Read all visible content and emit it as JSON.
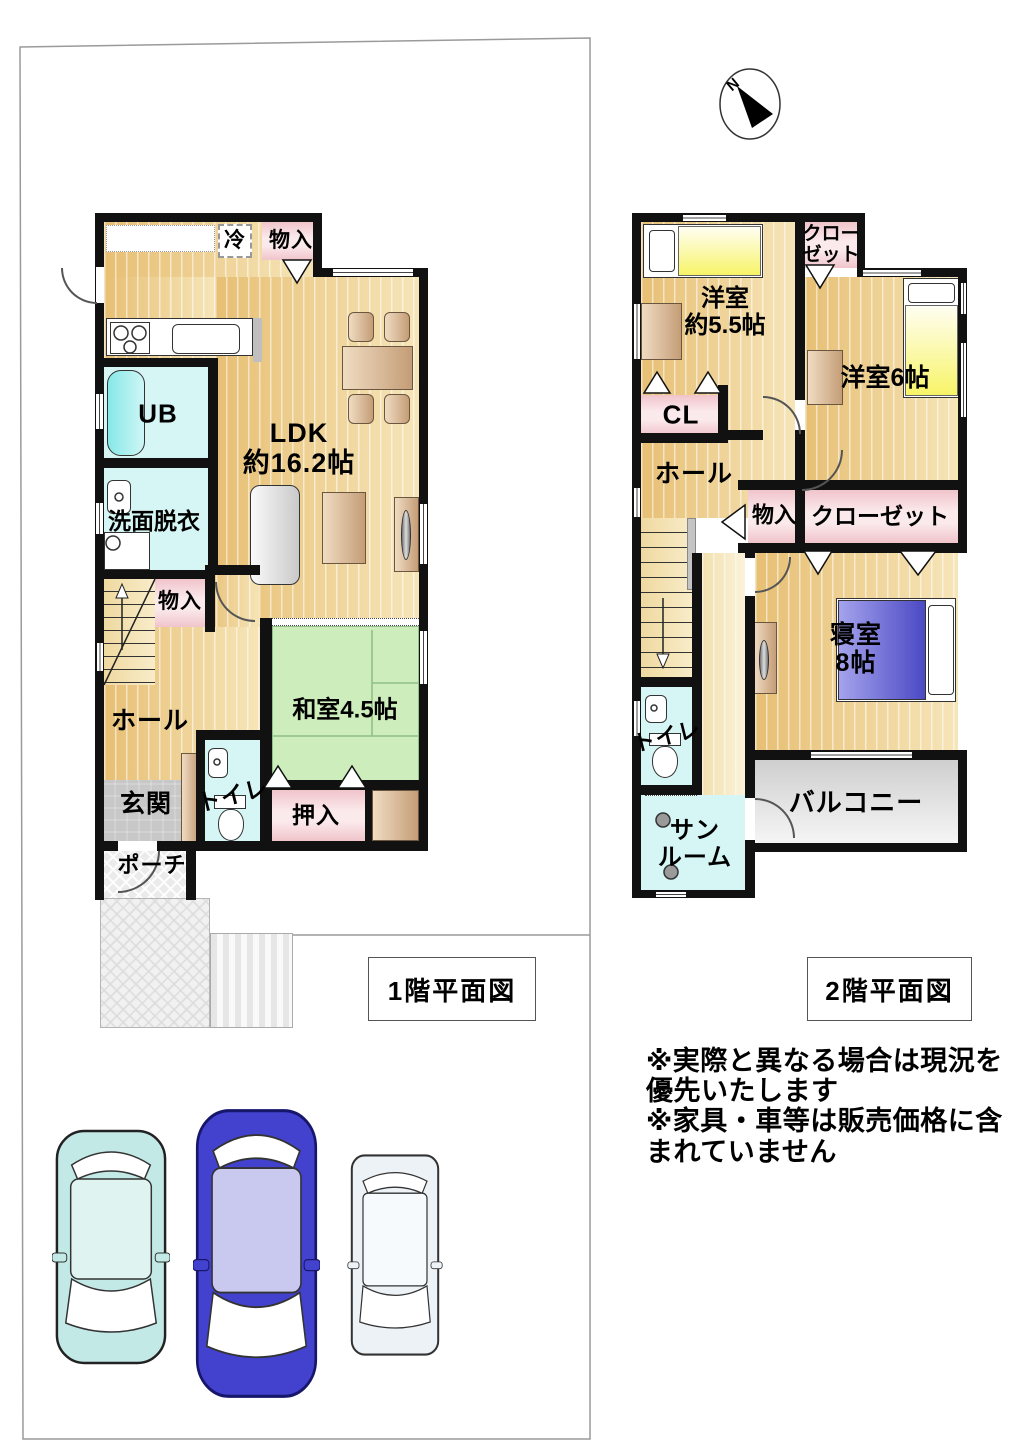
{
  "compass": {
    "north": "N"
  },
  "f1": {
    "title": "1階平面図",
    "rei": "冷",
    "monoire_top": "物入",
    "ub": "UB",
    "senmen": "洗面脱衣",
    "ldk": "LDK\n約16.2帖",
    "monoire": "物入",
    "hall": "ホール",
    "genkan": "玄関",
    "toilet": "トイレ",
    "washitsu": "和室4.5帖",
    "oshiire": "押入",
    "porch": "ポーチ"
  },
  "f2": {
    "title": "2階平面図",
    "yoshitsu55": "洋室\n約5.5帖",
    "closet_top": "クロー\nゼット",
    "yoshitsu6": "洋室6帖",
    "cl": "CL",
    "hall": "ホール",
    "monoire": "物入",
    "closet": "クローゼット",
    "shinshitsu": "寝室\n8帖",
    "toilet": "トイレ",
    "sunroom": "サン\nルーム",
    "balcony": "バルコニー"
  },
  "notes": "※実際と異なる場合は現況を\n優先いたします\n※家具・車等は販売価格に含\nまれていません",
  "colors": {
    "wood": "#E7BF74",
    "tatami": "#CDEEBC",
    "wet_room": "#D6F5F5",
    "closet_pink": "#F0C4CB",
    "balcony_gray": "#D9D9D9",
    "bed_yellow": "#F7F468",
    "bed_blue": "#4B49C4",
    "car_cyan": "#C2E9E5",
    "car_blue": "#4342CE",
    "car_white": "#EDF2F7"
  }
}
